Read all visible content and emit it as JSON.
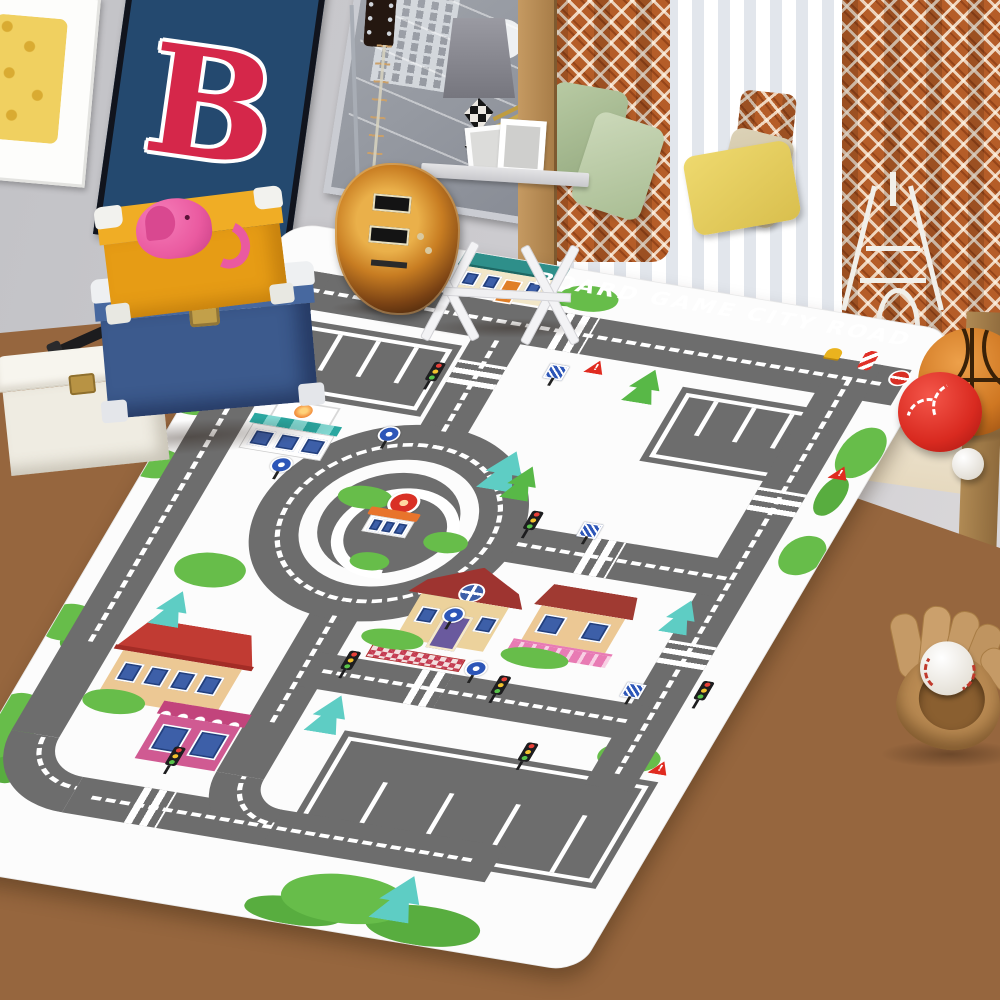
{
  "scene": {
    "description": "Kids bedroom photo: sunburst electric guitar, posters, stacked storage trunks, window seat with pillows, and a large city-road board game play rug on a wooden floor",
    "rug": {
      "title": "BOARD GAME CITY ROAD",
      "warning_mark": "!",
      "colors": {
        "road": "#6d6d6d",
        "rug_bg": "#fcfcfc",
        "grass": "#67bd4a",
        "teal_tree": "#5ecdc4",
        "house_roof_red": "#c13b33",
        "shop_pink": "#c2447c"
      }
    },
    "posters": {
      "letter_poster_text": "B",
      "letter_color": "#d5274a",
      "letter_poster_bg": "#24496f"
    },
    "inventory": [
      "waffle-art-poster",
      "letter-b-poster",
      "gray-concert-poster",
      "sunburst-electric-guitar",
      "guitar-stand",
      "gray-table-lamp",
      "white-x-frame-side-table",
      "picture-frames",
      "window-seat-bench",
      "sheer-curtain",
      "orange-diamond-curtains",
      "sage-green-pillows",
      "beige-pillow",
      "rust-pillow",
      "yellow-pillow",
      "eiffel-tower-figurine",
      "pink-elephant-toy",
      "yellow-trunk",
      "blue-trunk",
      "white-trunk",
      "telescope",
      "basketball",
      "red-ball",
      "white-ball",
      "baseball-glove",
      "baseball",
      "city-road-play-rug",
      "wooden-floor"
    ]
  }
}
